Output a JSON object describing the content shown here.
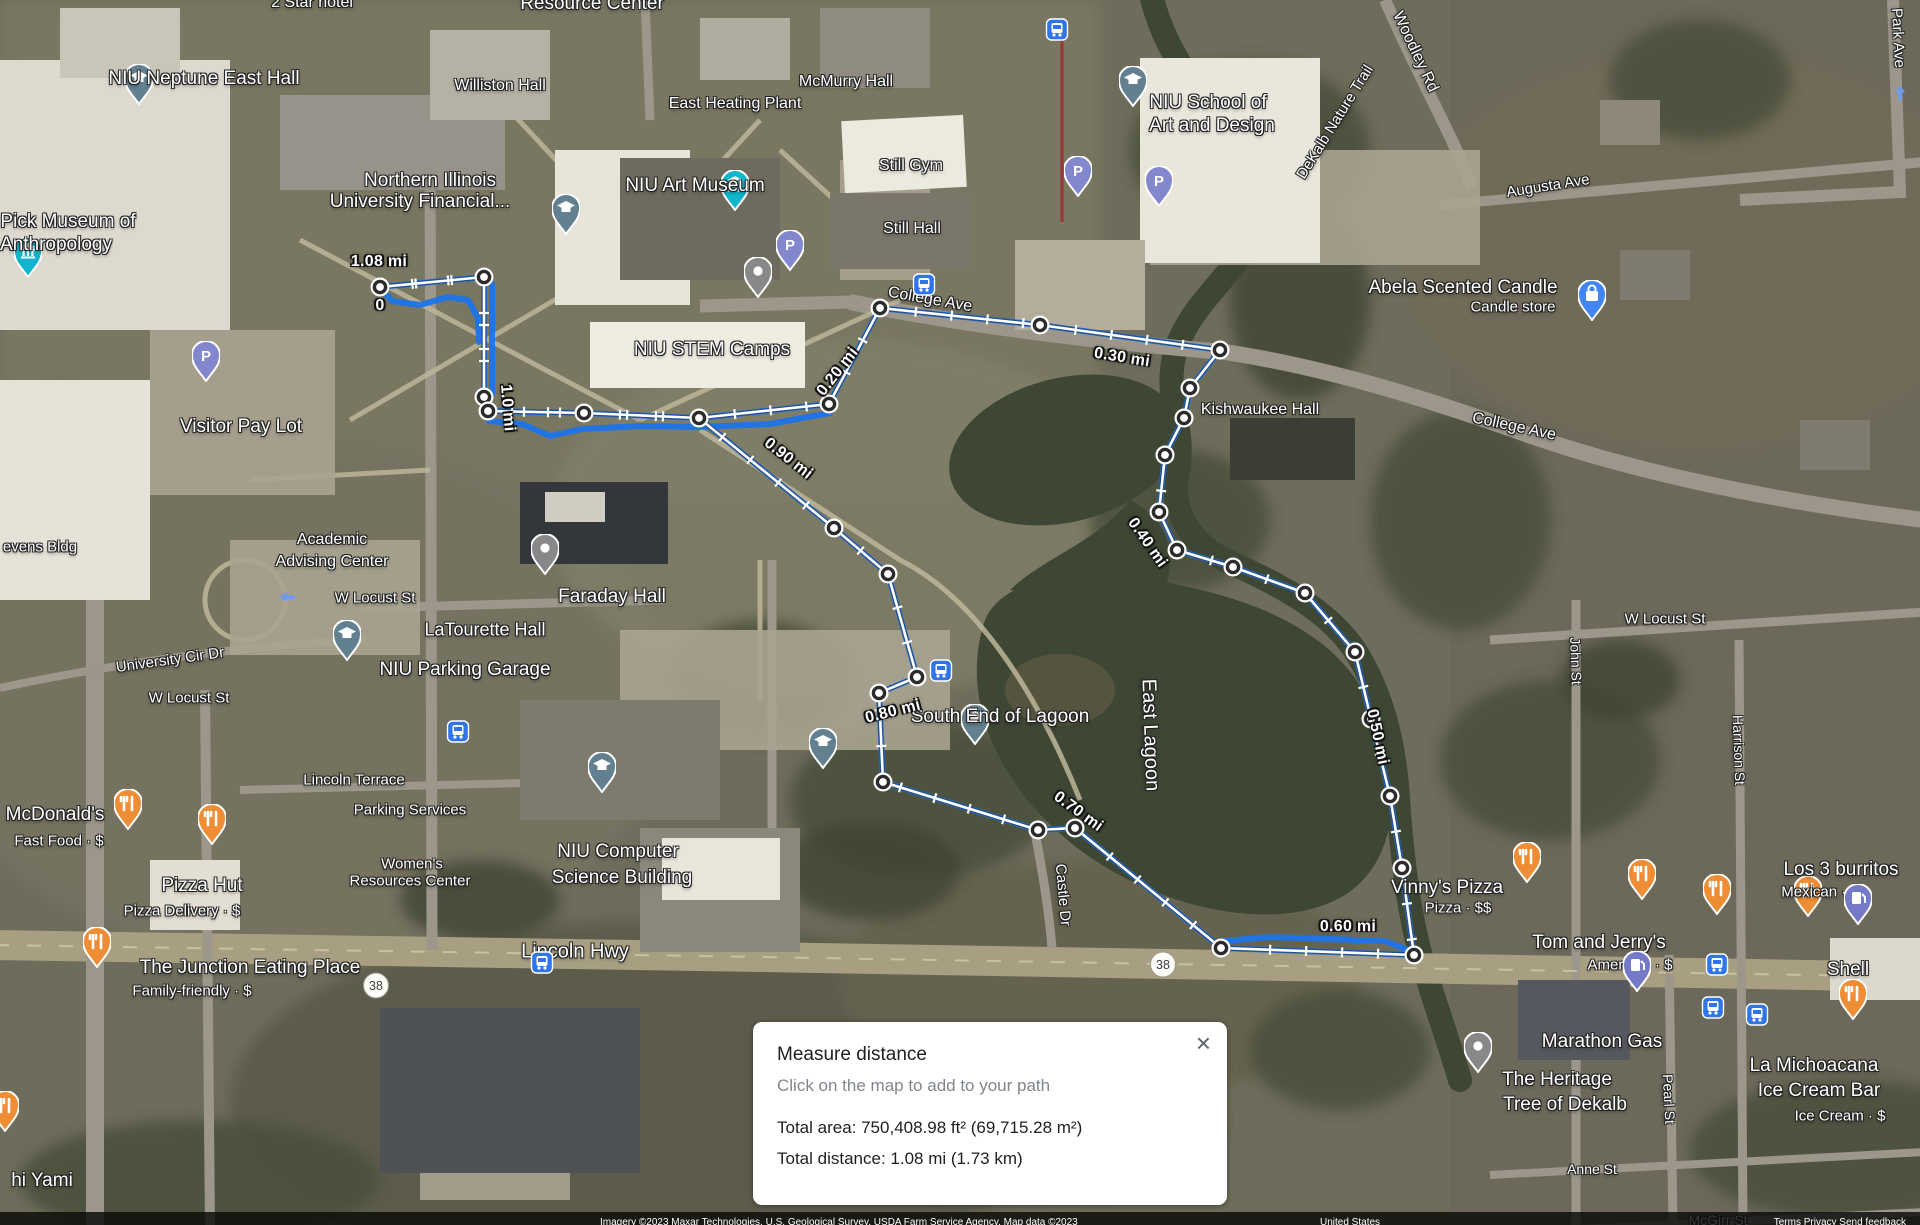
{
  "dialog": {
    "title": "Measure distance",
    "hint": "Click on the map to add to your path",
    "total_area": "Total area: 750,408.98 ft² (69,715.28 m²)",
    "total_distance": "Total distance: 1.08 mi (1.73 km)",
    "close_icon": "×"
  },
  "attribution": {
    "left": "Imagery ©2023 Maxar Technologies, U.S. Geological Survey, USDA Farm Service Agency, Map data ©2023",
    "center": "United States",
    "right": "Terms     Privacy     Send feedback"
  },
  "colors": {
    "route_blue": "#1c74e9",
    "measure_white": "#ffffff",
    "node_ring": "#2b2b2b",
    "pin_food": "#ee8d33",
    "pin_parking": "#8287ce",
    "pin_gas": "#7479c8",
    "pin_school": "#62808f",
    "pin_museum": "#12b5cb",
    "pin_bag": "#4285f4",
    "bus_blue": "#2f74ea",
    "water": "#3d4733"
  },
  "measure": {
    "total_label": "1.08 mi",
    "nodes": [
      [
        380,
        287
      ],
      [
        484,
        277
      ],
      [
        484,
        397
      ],
      [
        488,
        411
      ],
      [
        584,
        413
      ],
      [
        699,
        418
      ],
      [
        829,
        404
      ],
      [
        880,
        308
      ],
      [
        1040,
        325
      ],
      [
        1220,
        350
      ],
      [
        1190,
        388
      ],
      [
        1184,
        418
      ],
      [
        1165,
        455
      ],
      [
        1159,
        512
      ],
      [
        1177,
        550
      ],
      [
        1233,
        567
      ],
      [
        1305,
        593
      ],
      [
        1355,
        652
      ],
      [
        1371,
        719
      ],
      [
        1390,
        796
      ],
      [
        1402,
        868
      ],
      [
        1414,
        955
      ],
      [
        1221,
        948
      ],
      [
        1075,
        828
      ],
      [
        1038,
        830
      ],
      [
        883,
        782
      ],
      [
        879,
        693
      ],
      [
        917,
        677
      ],
      [
        888,
        574
      ],
      [
        834,
        528
      ]
    ],
    "path": [
      [
        380,
        287
      ],
      [
        484,
        277
      ],
      [
        484,
        397
      ],
      [
        488,
        411
      ],
      [
        584,
        413
      ],
      [
        699,
        418
      ],
      [
        829,
        404
      ],
      [
        880,
        308
      ],
      [
        1040,
        325
      ],
      [
        1220,
        350
      ],
      [
        1190,
        388
      ],
      [
        1184,
        418
      ],
      [
        1165,
        455
      ],
      [
        1159,
        512
      ],
      [
        1177,
        550
      ],
      [
        1233,
        567
      ],
      [
        1305,
        593
      ],
      [
        1355,
        652
      ],
      [
        1371,
        719
      ],
      [
        1390,
        796
      ],
      [
        1402,
        868
      ],
      [
        1414,
        955
      ],
      [
        1221,
        948
      ],
      [
        1075,
        828
      ],
      [
        1038,
        830
      ],
      [
        883,
        782
      ],
      [
        879,
        693
      ],
      [
        917,
        677
      ],
      [
        888,
        574
      ],
      [
        834,
        528
      ],
      [
        699,
        418
      ],
      [
        584,
        413
      ],
      [
        488,
        411
      ],
      [
        484,
        397
      ],
      [
        484,
        277
      ],
      [
        380,
        287
      ]
    ],
    "blue_extras": [
      [
        [
          380,
          287
        ],
        [
          392,
          301
        ],
        [
          420,
          305
        ],
        [
          448,
          297
        ],
        [
          468,
          300
        ],
        [
          478,
          318
        ],
        [
          479,
          342
        ]
      ],
      [
        [
          489,
          421
        ],
        [
          522,
          424
        ],
        [
          550,
          436
        ],
        [
          582,
          429
        ],
        [
          640,
          426
        ],
        [
          700,
          427
        ],
        [
          770,
          424
        ],
        [
          830,
          413
        ]
      ],
      [
        [
          492,
          284
        ],
        [
          492,
          394
        ]
      ],
      [
        [
          1224,
          941
        ],
        [
          1270,
          937
        ],
        [
          1330,
          939
        ],
        [
          1385,
          941
        ],
        [
          1408,
          950
        ]
      ]
    ],
    "distance_labels": [
      {
        "t": "1.08 mi",
        "x": 379,
        "y": 262,
        "r": 0
      },
      {
        "t": "0",
        "x": 380,
        "y": 306,
        "r": 0
      },
      {
        "t": "1.0 mi",
        "x": 507,
        "y": 408,
        "r": 85
      },
      {
        "t": "0.20 mi",
        "x": 838,
        "y": 372,
        "r": -52
      },
      {
        "t": "0.30 mi",
        "x": 1122,
        "y": 358,
        "r": 9
      },
      {
        "t": "0.40 mi",
        "x": 1147,
        "y": 543,
        "r": 55
      },
      {
        "t": "0.50 mi",
        "x": 1377,
        "y": 737,
        "r": 78
      },
      {
        "t": "0.60 mi",
        "x": 1348,
        "y": 927,
        "r": 0
      },
      {
        "t": "0.70 mi",
        "x": 1078,
        "y": 812,
        "r": 36
      },
      {
        "t": "0.80 mi",
        "x": 893,
        "y": 712,
        "r": -14
      },
      {
        "t": "0.90 mi",
        "x": 788,
        "y": 459,
        "r": 38
      }
    ]
  },
  "pois": [
    {
      "type": "food",
      "x": 128,
      "y": 835,
      "lines": [
        {
          "t": "McDonald's",
          "x": 55,
          "y": 815
        }
      ],
      "sub": {
        "t": "Fast Food · $",
        "x": 59,
        "y": 841
      }
    },
    {
      "type": "food",
      "x": 212,
      "y": 850,
      "lines": [
        {
          "t": "Pizza Hut",
          "x": 202,
          "y": 886
        }
      ],
      "sub": {
        "t": "Pizza Delivery · $",
        "x": 182,
        "y": 911
      }
    },
    {
      "type": "food",
      "x": 97,
      "y": 973,
      "lines": [
        {
          "t": "The Junction Eating Place",
          "x": 250,
          "y": 968
        }
      ],
      "sub": {
        "t": "Family-friendly · $",
        "x": 192,
        "y": 991
      }
    },
    {
      "type": "food",
      "x": 5,
      "y": 1137,
      "lines": [
        {
          "t": "hi Yami",
          "x": 42,
          "y": 1181
        }
      ]
    },
    {
      "type": "food",
      "x": 1527,
      "y": 888,
      "lines": [
        {
          "t": "Vinny's Pizza",
          "x": 1447,
          "y": 888
        }
      ],
      "sub": {
        "t": "Pizza · $$",
        "x": 1458,
        "y": 908
      }
    },
    {
      "type": "food",
      "x": 1642,
      "y": 905,
      "lines": [
        {
          "t": "Tom and Jerry's",
          "x": 1599,
          "y": 943
        }
      ],
      "sub": {
        "t": "American · $",
        "x": 1630,
        "y": 965
      }
    },
    {
      "type": "food",
      "x": 1808,
      "y": 922,
      "lines": [
        {
          "t": "Los 3 burritos",
          "x": 1841,
          "y": 870
        }
      ],
      "sub": {
        "t": "Mexican · $",
        "x": 1820,
        "y": 892
      }
    },
    {
      "type": "food",
      "x": 1853,
      "y": 1025,
      "lines": [
        {
          "t": "La Michoacana",
          "x": 1814,
          "y": 1066
        },
        {
          "t": "Ice Cream Bar",
          "x": 1819,
          "y": 1091
        }
      ],
      "sub": {
        "t": "Ice Cream · $",
        "x": 1840,
        "y": 1116
      }
    },
    {
      "type": "food",
      "x": 1717,
      "y": 920,
      "lines": []
    },
    {
      "type": "gas",
      "x": 1858,
      "y": 930,
      "lines": [
        {
          "t": "Shell",
          "x": 1848,
          "y": 970
        }
      ]
    },
    {
      "type": "gas",
      "x": 1637,
      "y": 997,
      "lines": [
        {
          "t": "Marathon Gas",
          "x": 1602,
          "y": 1042
        }
      ]
    },
    {
      "type": "parking",
      "x": 206,
      "y": 387,
      "lines": [
        {
          "t": "Visitor Pay Lot",
          "x": 241,
          "y": 427
        }
      ]
    },
    {
      "type": "parking",
      "x": 790,
      "y": 276,
      "lines": []
    },
    {
      "type": "parking",
      "x": 1159,
      "y": 212,
      "lines": []
    },
    {
      "type": "parking",
      "x": 1078,
      "y": 202,
      "lines": []
    },
    {
      "type": "school",
      "x": 139,
      "y": 110,
      "lines": [
        {
          "t": "NIU Neptune East Hall",
          "x": 204,
          "y": 79
        }
      ]
    },
    {
      "type": "school",
      "x": 566,
      "y": 240,
      "lines": [
        {
          "t": "Northern Illinois",
          "x": 430,
          "y": 181
        },
        {
          "t": "University Financial...",
          "x": 420,
          "y": 202
        }
      ]
    },
    {
      "type": "school",
      "x": 347,
      "y": 666,
      "lines": [
        {
          "t": "NIU Parking Garage",
          "x": 465,
          "y": 670
        }
      ]
    },
    {
      "type": "school",
      "x": 602,
      "y": 798,
      "lines": [
        {
          "t": "NIU Computer",
          "x": 618,
          "y": 852
        },
        {
          "t": "Science Building",
          "x": 622,
          "y": 878
        }
      ]
    },
    {
      "type": "school",
      "x": 823,
      "y": 774,
      "lines": []
    },
    {
      "type": "school",
      "x": 975,
      "y": 750,
      "lines": [
        {
          "t": "South End of Lagoon",
          "x": 1000,
          "y": 717
        }
      ]
    },
    {
      "type": "school",
      "x": 1133,
      "y": 112,
      "lines": [
        {
          "t": "NIU School of",
          "x": 1208,
          "y": 103
        },
        {
          "t": "Art and Design",
          "x": 1212,
          "y": 126
        }
      ]
    },
    {
      "type": "dot",
      "x": 758,
      "y": 303,
      "lines": [
        {
          "t": "NIU STEM Camps",
          "x": 712,
          "y": 350
        }
      ]
    },
    {
      "type": "dot",
      "x": 545,
      "y": 580,
      "lines": [
        {
          "t": "Faraday Hall",
          "x": 612,
          "y": 597
        }
      ]
    },
    {
      "type": "dot",
      "x": 1478,
      "y": 1078,
      "lines": [
        {
          "t": "The Heritage",
          "x": 1557,
          "y": 1080
        },
        {
          "t": "Tree of Dekalb",
          "x": 1565,
          "y": 1105
        }
      ]
    },
    {
      "type": "museum",
      "x": 28,
      "y": 283,
      "lines": [
        {
          "t": "Pick Museum of",
          "x": 68,
          "y": 222
        },
        {
          "t": "Anthropology",
          "x": 56,
          "y": 245
        }
      ]
    },
    {
      "type": "museum",
      "x": 735,
      "y": 216,
      "lines": [
        {
          "t": "NIU Art Museum",
          "x": 695,
          "y": 186
        }
      ]
    },
    {
      "type": "bag",
      "x": 1592,
      "y": 326,
      "lines": [
        {
          "t": "Abela Scented Candle",
          "x": 1463,
          "y": 288
        }
      ],
      "sub": {
        "t": "Candle store",
        "x": 1513,
        "y": 307
      }
    }
  ],
  "labels": [
    {
      "t": "2 Star hotel",
      "x": 312,
      "y": 3,
      "r": 0,
      "s": 16
    },
    {
      "t": "Resource Center",
      "x": 592,
      "y": 4,
      "r": 0,
      "s": 19
    },
    {
      "t": "Williston Hall",
      "x": 500,
      "y": 86,
      "r": 0,
      "s": 16
    },
    {
      "t": "East Heating Plant",
      "x": 735,
      "y": 104,
      "r": 0,
      "s": 16
    },
    {
      "t": "McMurry Hall",
      "x": 846,
      "y": 82,
      "r": 0,
      "s": 16
    },
    {
      "t": "Still Gym",
      "x": 911,
      "y": 166,
      "r": 0,
      "s": 16
    },
    {
      "t": "Still Hall",
      "x": 912,
      "y": 229,
      "r": 0,
      "s": 16
    },
    {
      "t": "Kishwaukee Hall",
      "x": 1260,
      "y": 410,
      "r": 0,
      "s": 16
    },
    {
      "t": "College Ave",
      "x": 930,
      "y": 300,
      "r": 10,
      "s": 16
    },
    {
      "t": "College Ave",
      "x": 1514,
      "y": 427,
      "r": 12,
      "s": 16
    },
    {
      "t": "Woodley Rd",
      "x": 1415,
      "y": 52,
      "r": 65,
      "s": 16
    },
    {
      "t": "DeKalb Nature Trail",
      "x": 1335,
      "y": 122,
      "r": -58,
      "s": 15
    },
    {
      "t": "Augusta Ave",
      "x": 1548,
      "y": 186,
      "r": -9,
      "s": 15
    },
    {
      "t": "Park Ave",
      "x": 1898,
      "y": 38,
      "r": 87,
      "s": 15
    },
    {
      "t": "evens Bldg",
      "x": 40,
      "y": 547,
      "r": 0,
      "s": 15
    },
    {
      "t": "Academic",
      "x": 332,
      "y": 540,
      "r": 0,
      "s": 16
    },
    {
      "t": "Advising Center",
      "x": 332,
      "y": 562,
      "r": 0,
      "s": 16
    },
    {
      "t": "W Locust St",
      "x": 375,
      "y": 598,
      "r": 0,
      "s": 15
    },
    {
      "t": "University Cir Dr",
      "x": 170,
      "y": 660,
      "r": -8,
      "s": 15
    },
    {
      "t": "W Locust St",
      "x": 189,
      "y": 698,
      "r": 0,
      "s": 15
    },
    {
      "t": "LaTourette Hall",
      "x": 485,
      "y": 630,
      "r": 0,
      "s": 18
    },
    {
      "t": "Lincoln Terrace",
      "x": 354,
      "y": 780,
      "r": 0,
      "s": 15
    },
    {
      "t": "Parking Services",
      "x": 410,
      "y": 810,
      "r": 0,
      "s": 15
    },
    {
      "t": "Women's",
      "x": 412,
      "y": 864,
      "r": 0,
      "s": 15
    },
    {
      "t": "Resources Center",
      "x": 410,
      "y": 881,
      "r": 0,
      "s": 15
    },
    {
      "t": "East Lagoon",
      "x": 1150,
      "y": 735,
      "r": 88,
      "s": 20
    },
    {
      "t": "Castle Dr",
      "x": 1063,
      "y": 895,
      "r": 85,
      "s": 15
    },
    {
      "t": "Lincoln Hwy",
      "x": 575,
      "y": 952,
      "r": 0,
      "s": 20
    },
    {
      "t": "W Locust St",
      "x": 1665,
      "y": 619,
      "r": 0,
      "s": 15
    },
    {
      "t": "John St",
      "x": 1576,
      "y": 661,
      "r": 88,
      "s": 14
    },
    {
      "t": "Harrison St",
      "x": 1739,
      "y": 750,
      "r": 88,
      "s": 14
    },
    {
      "t": "Pearl St",
      "x": 1669,
      "y": 1099,
      "r": 87,
      "s": 14
    },
    {
      "t": "Anne St",
      "x": 1592,
      "y": 1169,
      "r": 0,
      "s": 14
    },
    {
      "t": "McGirr St",
      "x": 1718,
      "y": 1220,
      "r": 0,
      "s": 14
    }
  ],
  "route_shields": [
    {
      "t": "38",
      "x": 376,
      "y": 988
    },
    {
      "t": "38",
      "x": 1163,
      "y": 967
    }
  ],
  "bus_stops": [
    [
      924,
      287
    ],
    [
      1057,
      32
    ],
    [
      941,
      673
    ],
    [
      458,
      734
    ],
    [
      542,
      965
    ],
    [
      1717,
      967
    ],
    [
      1713,
      1010
    ],
    [
      1757,
      1017
    ]
  ],
  "one_way_arrows": [
    [
      290,
      597,
      -90
    ],
    [
      1900,
      96,
      0
    ]
  ]
}
